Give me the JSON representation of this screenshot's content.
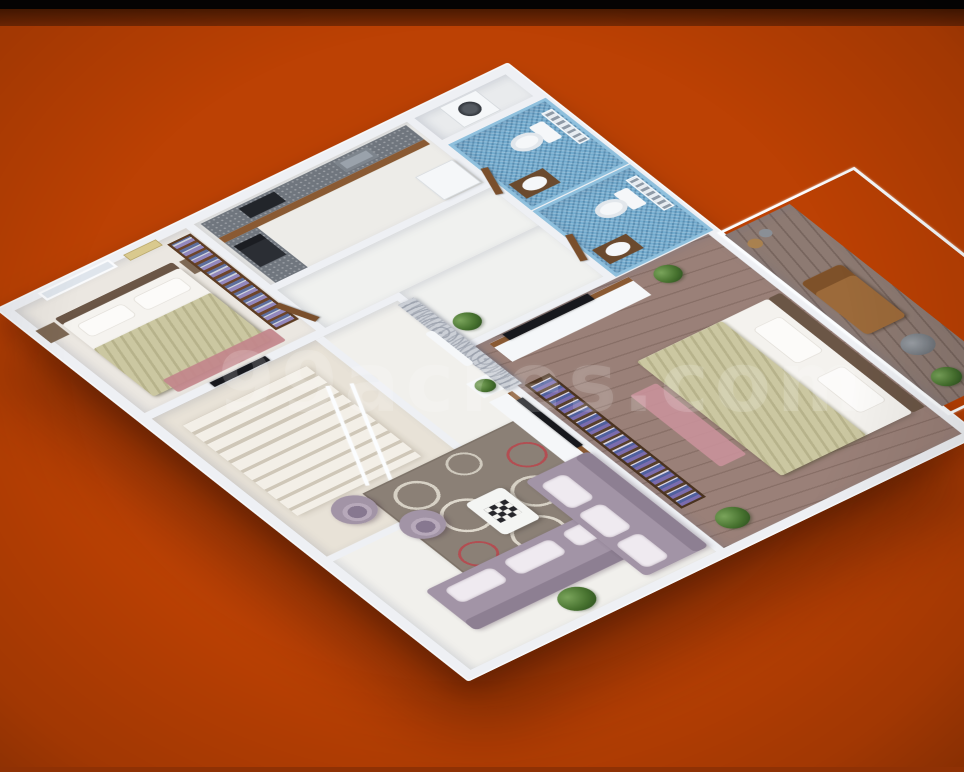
{
  "watermark": {
    "text": "99acres.com"
  },
  "background": {
    "main": "#bc4104",
    "top_bar": "#060404",
    "top_band": "#7b2a04",
    "bottom_strip": "#8f3104"
  },
  "render": {
    "type": "isometric-3d-floor-plan",
    "rooms": [
      {
        "id": "bedroom-1",
        "floor": "#ebe7e1",
        "features": [
          "double-bed",
          "olive-blanket",
          "wardrobe-with-clothes",
          "window",
          "red-rug",
          "wall-tv",
          "nightstands"
        ]
      },
      {
        "id": "kitchen",
        "floor": "#edece8",
        "features": [
          "l-shaped-granite-counter",
          "hob",
          "sink",
          "oven",
          "refrigerator",
          "wood-cabinets"
        ]
      },
      {
        "id": "utility",
        "floor": "#e9ebed",
        "features": [
          "washing-machine"
        ]
      },
      {
        "id": "bathroom-1",
        "floor": "#72abce",
        "features": [
          "blue-mosaic-tiles",
          "toilet",
          "washbasin",
          "louvre-window",
          "wood-vanity",
          "door"
        ]
      },
      {
        "id": "bathroom-2",
        "floor": "#72abce",
        "features": [
          "blue-mosaic-tiles",
          "toilet",
          "washbasin",
          "louvre-window",
          "wood-vanity",
          "door"
        ]
      },
      {
        "id": "hallway",
        "floor": "#f0f1ef",
        "features": [
          "swirl-feature-wall",
          "white-shelf",
          "potted-plant",
          "doors"
        ]
      },
      {
        "id": "staircase-room",
        "floor": "#e8e2d7",
        "features": [
          "staircase",
          "white-railing"
        ]
      },
      {
        "id": "living-room",
        "floor": "#f1f0ec",
        "features": [
          "l-shaped-sofa",
          "two-tub-chairs",
          "circle-pattern-rug",
          "coffee-table-with-chessboard",
          "tv-console",
          "potted-plants"
        ]
      },
      {
        "id": "master-bedroom",
        "floor": "#9a8078",
        "features": [
          "double-bed",
          "olive-blanket",
          "tv-cabinet",
          "bookshelf",
          "wood-plank-floor",
          "pink-rug",
          "potted-plants"
        ]
      },
      {
        "id": "balcony",
        "floor": "#8d7a72",
        "features": [
          "wood-deck",
          "lounger",
          "round-table",
          "potted-plant",
          "white-railing-outline"
        ]
      }
    ],
    "palette": {
      "walls": "#eef0f4",
      "wood": "#8a5a33",
      "granite": "#70767e",
      "bathroom_tile": "#72abce",
      "sofa": "#a294a6",
      "blanket": "#cbc7a1",
      "wood_floor": "#9a8078",
      "rug": "#8b8076",
      "rug_ring_red": "#b24e52",
      "plant": "#47722f",
      "red_rug": "#c2868b",
      "pink_rug": "#c9919a"
    }
  }
}
